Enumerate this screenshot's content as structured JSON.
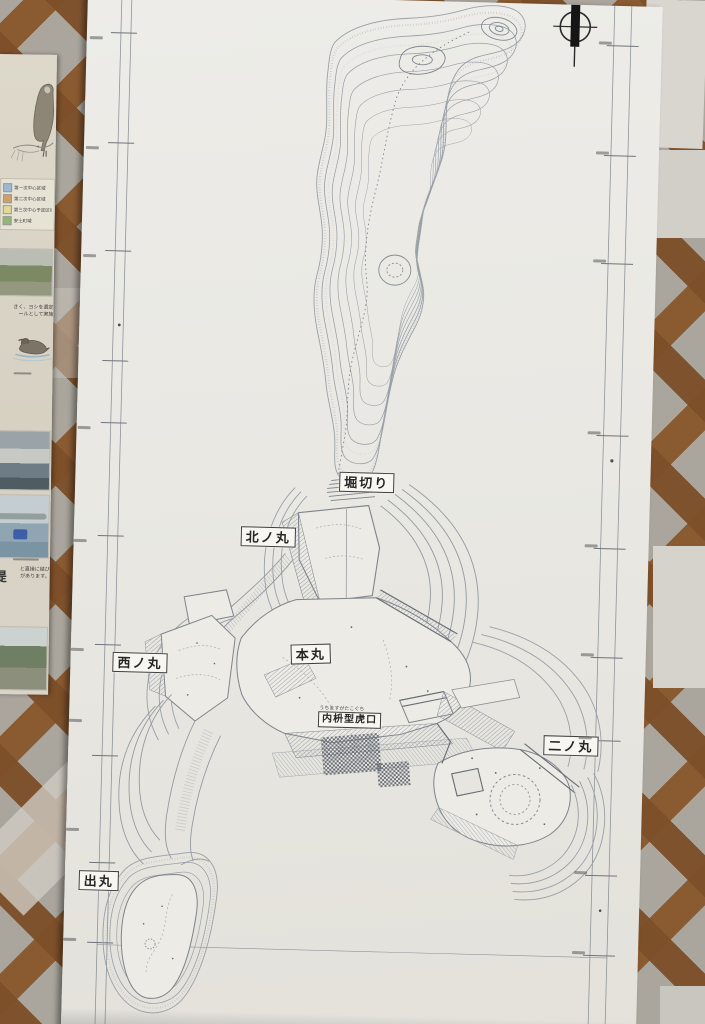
{
  "map": {
    "labels": {
      "horikiri": "堀切り",
      "kitanomaru": "北ノ丸",
      "honmaru": "本丸",
      "nishinomaru": "西ノ丸",
      "ninomaru": "二ノ丸",
      "uchimasugata": "内枡型虎口",
      "uchimasugata_furigana": "うちますがたこぐち",
      "demaru": "出丸"
    },
    "line_color": "#9aa0a8",
    "paper_color": "#e9e8e3"
  },
  "sidebar": {
    "legend": [
      {
        "color": "#9db8d2",
        "label": "第一次中心区域"
      },
      {
        "color": "#cfa06a",
        "label": "第二次中心区域"
      },
      {
        "color": "#e3d996",
        "label": "第三次中心予定区域"
      },
      {
        "color": "#93b477",
        "label": "安土町域"
      }
    ],
    "text_block_1_line1": "きく、ヨシを選定",
    "text_block_1_line2": "ールとして実施",
    "text_block_2_line1": "と直接に結び",
    "text_block_2_line2": "があります。",
    "text_block_2_heading": "堤"
  }
}
